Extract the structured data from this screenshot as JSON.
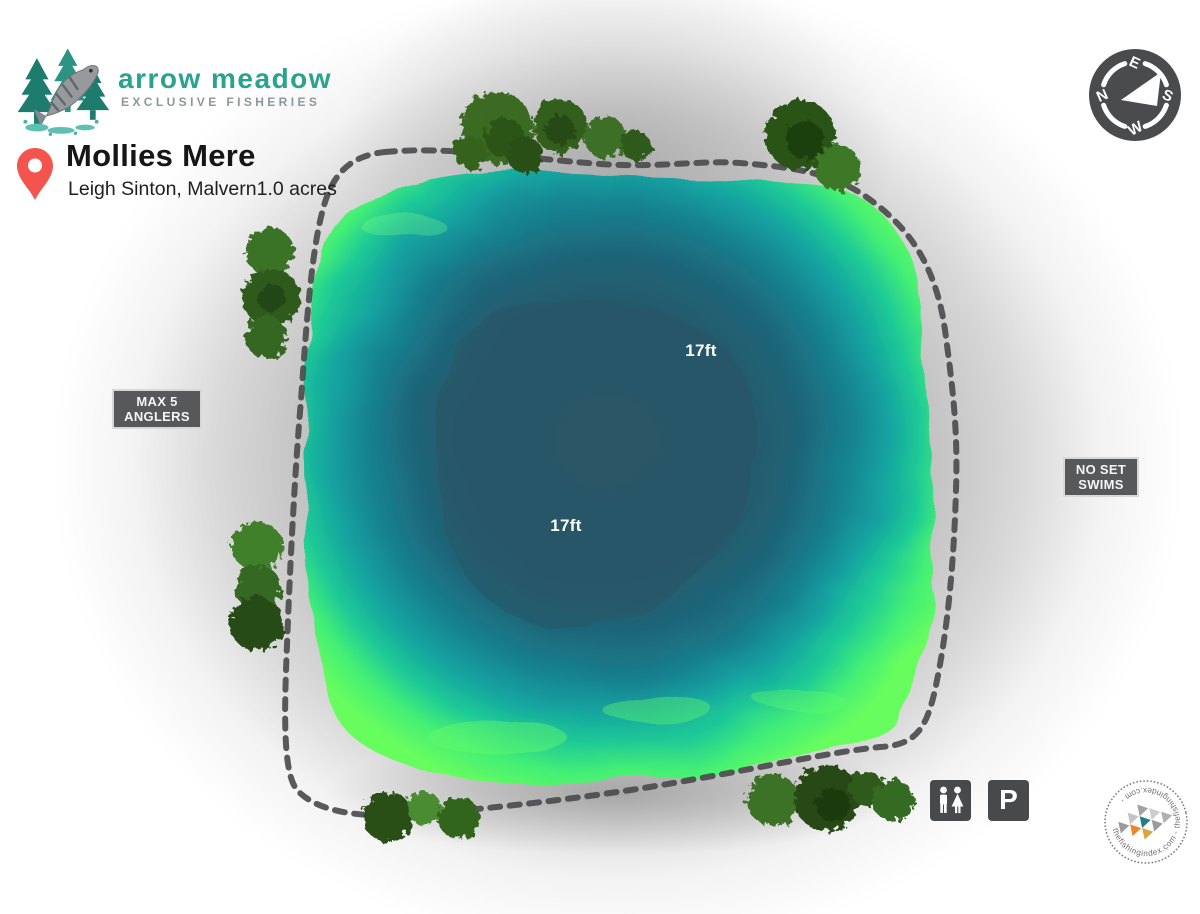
{
  "page": {
    "type": "fishery lake depth map"
  },
  "brand": {
    "name": "arrow meadow",
    "tagline": "EXCLUSIVE FISHERIES"
  },
  "venue": {
    "title": "Mollies Mere",
    "location": "Leigh Sinton, Malvern",
    "size": "1.0 acres"
  },
  "lake": {
    "depth_labels": [
      {
        "text": "17ft"
      },
      {
        "text": "17ft"
      }
    ]
  },
  "badges": {
    "max_anglers": {
      "line1": "MAX 5",
      "line2": "ANGLERS"
    },
    "no_set_swims": {
      "line1": "NO SET",
      "line2": "SWIMS"
    }
  },
  "compass": {
    "north": "N",
    "east": "E",
    "south": "S",
    "west": "W"
  },
  "facilities": [
    {
      "icon": "toilets-icon"
    },
    {
      "icon": "parking-icon",
      "label": "P"
    }
  ],
  "stamp": {
    "text": "thefishingindex.com - thefishingindex.com -"
  },
  "icons": {
    "logo": "fish-jumping-with-pines-icon",
    "pin": "location-pin-icon",
    "compass": "compass-rose-icon"
  },
  "colors": {
    "accent_teal": "#2aa38e",
    "tagline_gray": "#8e969d",
    "pin_red": "#f3544e",
    "badge_bg": "#57585a",
    "badge_border": "#d8d8d8",
    "compass_bg": "#4a4b4d",
    "facility_bg": "#48494b",
    "path_dash": "#4c4c4e",
    "lake_shallow_green": "#66fd60",
    "lake_teal": "#14a3a0",
    "lake_deep_blue": "#235a6c",
    "lake_core": "#2a5363",
    "tree_dark_green": "#284e15",
    "tree_light_green": "#4a8c33",
    "stamp_orange": "#ee8329",
    "stamp_teal": "#1e7e8d",
    "stamp_mustard": "#d8a63e",
    "stamp_gray": "#9b9b9b"
  }
}
